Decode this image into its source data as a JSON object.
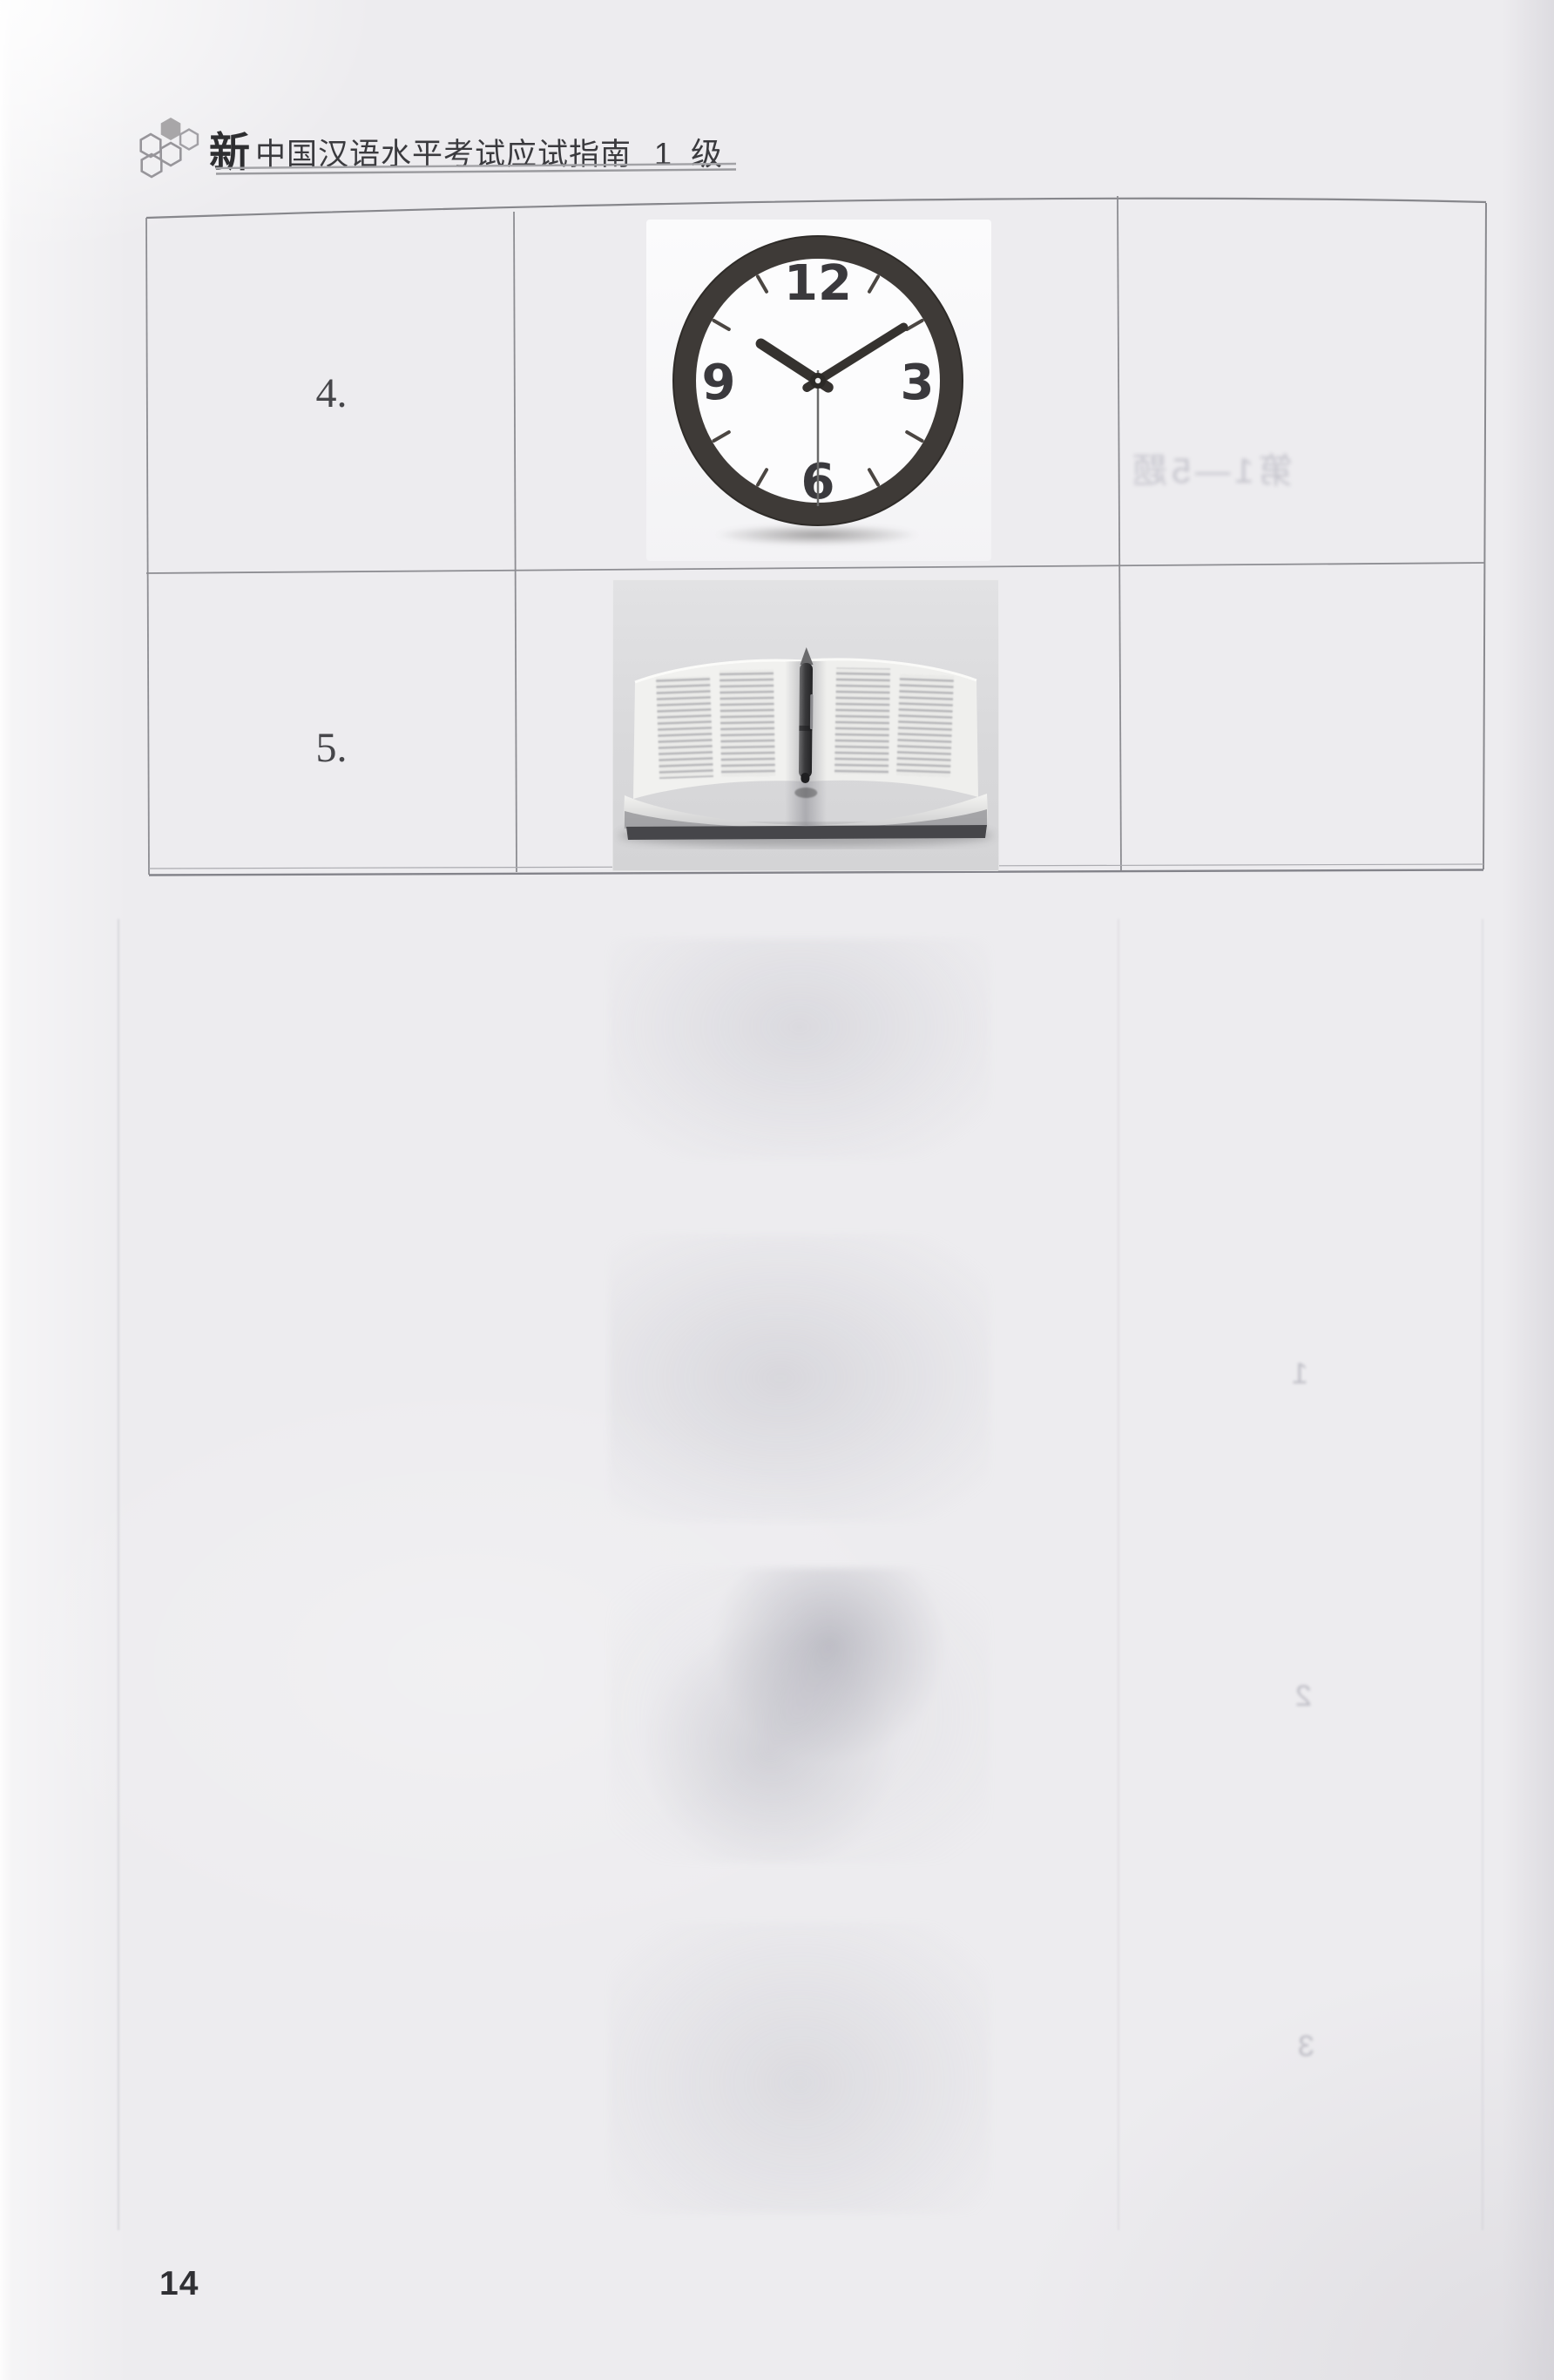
{
  "page": {
    "number": "14",
    "paper_color": "#edecef"
  },
  "header": {
    "title_prefix": "新",
    "title_main": "中国汉语水平考试应试指南",
    "level": "1 级",
    "logo_fill_color": "#a8a6a8",
    "logo_outline_color": "#97959a",
    "underline_color": "#9a9a9e",
    "title_color": "#3a3a3e"
  },
  "table": {
    "border_color": "#8d8d92",
    "rows": [
      {
        "label": "4.",
        "image": "wall-clock-photo"
      },
      {
        "label": "5.",
        "image": "open-book-with-pen-photo"
      }
    ]
  },
  "clock": {
    "time_shown": "10:11:30",
    "numerals": [
      "12",
      "3",
      "6",
      "9"
    ],
    "frame_color": "#3e3a37",
    "face_color": "#fcfcfd",
    "hand_color": "#35322f",
    "numeral_color": "#3a393d",
    "hour_transform": "rotate(-57 200 200)",
    "minute_transform": "rotate(58 200 200)",
    "second_transform": "rotate(180 200 200)",
    "tick_angles": [
      30,
      60,
      120,
      150,
      210,
      240,
      300,
      330
    ]
  },
  "book_photo": {
    "subject": "open-dictionary-with-pen",
    "background_color": "#d9d9db",
    "page_color": "#f1f1ef",
    "pen_color": "#3a3a3c"
  },
  "ghosts": {
    "cell3_text": "第1—5题",
    "numbers": [
      "1",
      "2",
      "3"
    ]
  }
}
